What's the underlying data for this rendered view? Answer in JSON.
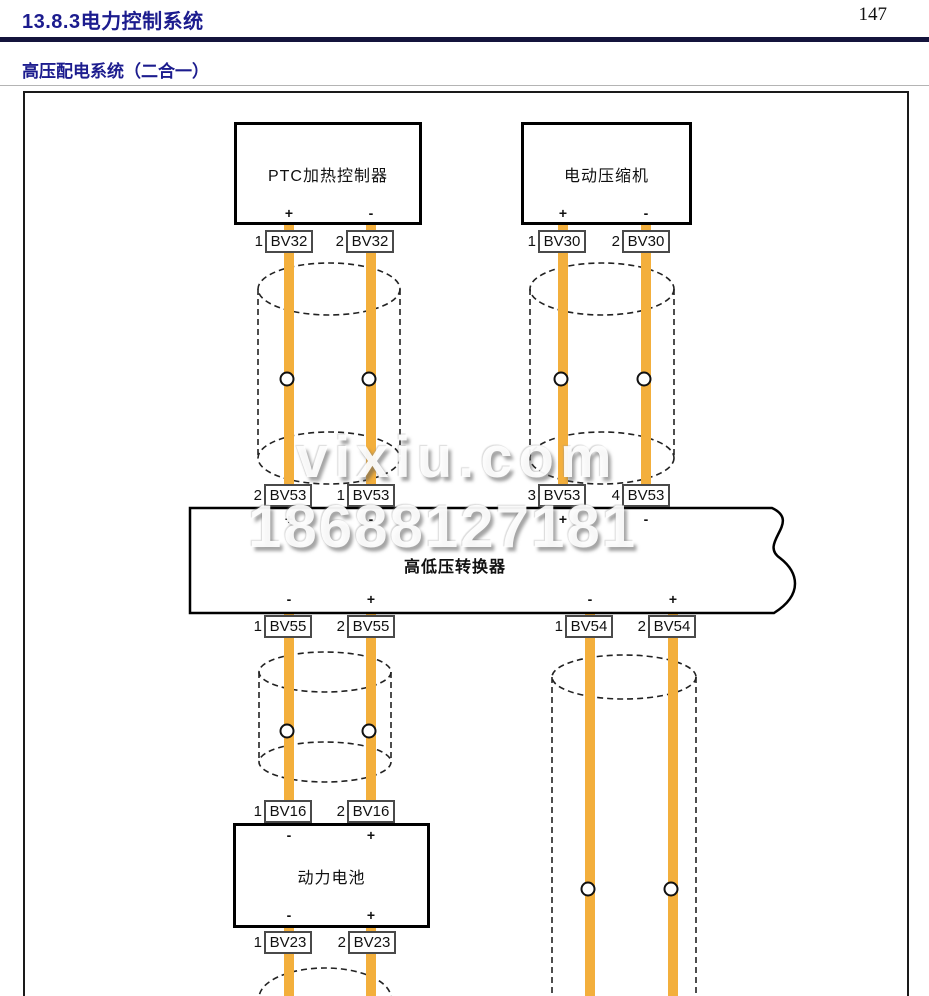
{
  "colors": {
    "heading": "#1c1c8e",
    "wire": "#f3af3c"
  },
  "header": {
    "section_title": "13.8.3电力控制系统",
    "page_number": "147",
    "subtitle": "高压配电系统（二合一）"
  },
  "watermark": {
    "site": "vixiu.com",
    "phone": "18688127181"
  },
  "diagram": {
    "components": {
      "ptc": {
        "label": "PTC加热控制器",
        "bottom_terminals": [
          "+",
          "-"
        ]
      },
      "compressor": {
        "label": "电动压缩机",
        "bottom_terminals": [
          "+",
          "-"
        ]
      },
      "converter": {
        "label": "高低压转换器",
        "top_terminals": [
          "+",
          "-",
          "+",
          "-"
        ],
        "bottom_terminals": [
          "-",
          "+",
          "-",
          "+"
        ]
      },
      "battery": {
        "label": "动力电池",
        "top_terminals": [
          "-",
          "+"
        ],
        "bottom_terminals": [
          "-",
          "+"
        ]
      }
    },
    "connectors": [
      {
        "pin": "1",
        "label": "BV32"
      },
      {
        "pin": "2",
        "label": "BV32"
      },
      {
        "pin": "1",
        "label": "BV30"
      },
      {
        "pin": "2",
        "label": "BV30"
      },
      {
        "pin": "2",
        "label": "BV53"
      },
      {
        "pin": "1",
        "label": "BV53"
      },
      {
        "pin": "3",
        "label": "BV53"
      },
      {
        "pin": "4",
        "label": "BV53"
      },
      {
        "pin": "1",
        "label": "BV55"
      },
      {
        "pin": "2",
        "label": "BV55"
      },
      {
        "pin": "1",
        "label": "BV54"
      },
      {
        "pin": "2",
        "label": "BV54"
      },
      {
        "pin": "1",
        "label": "BV16"
      },
      {
        "pin": "2",
        "label": "BV16"
      },
      {
        "pin": "1",
        "label": "BV23"
      },
      {
        "pin": "2",
        "label": "BV23"
      }
    ]
  }
}
